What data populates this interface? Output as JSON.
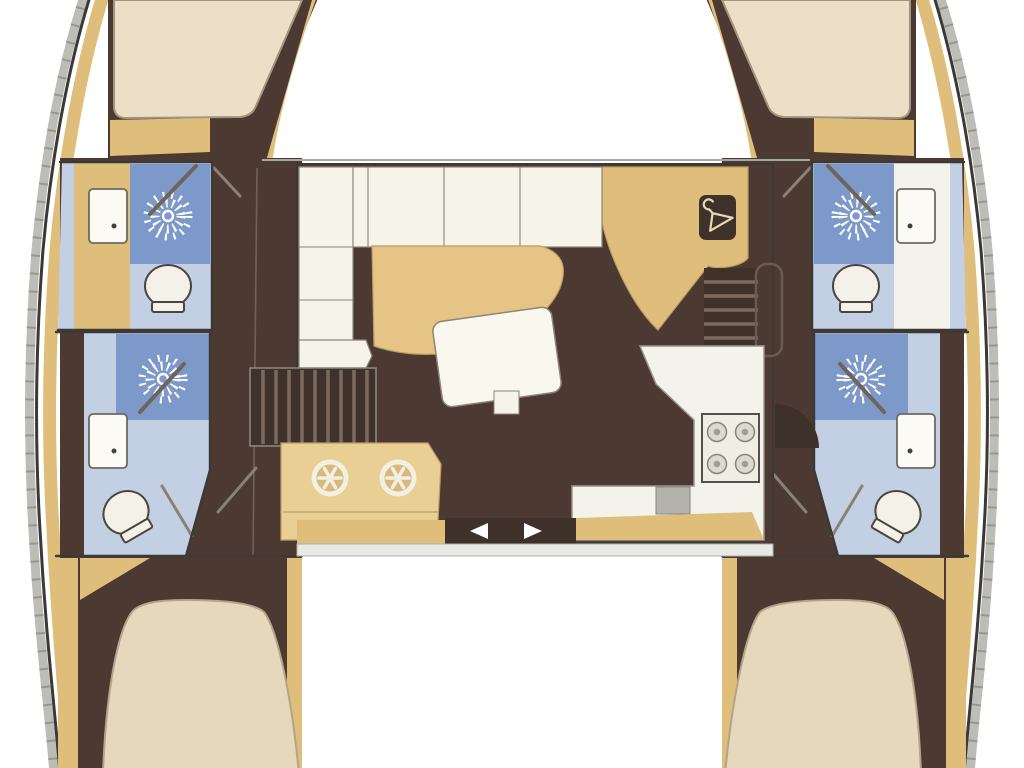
{
  "description": "Top-down floor plan of a 4-cabin / 4-head sailing catamaran: two symmetric hulls joined by a central salon with galley",
  "palette": {
    "background": "#ffffff",
    "hull_floor": "#4c3a32",
    "hull_floor_dark": "#3e3129",
    "wood": "#dfbe7b",
    "wood_light": "#e9cf94",
    "wood_table": "#e5c486",
    "mattress": "#ebdfc7",
    "mattress_aft": "#e6d8bd",
    "sofa": "#f6f3e9",
    "table_white": "#faf7ee",
    "counter_white": "#f3f3ec",
    "stove_body": "#efede4",
    "shower_blue": "#7d99ca",
    "bath_blue": "#c3cfe3",
    "fixture_white": "#f4f1e9",
    "sink_grey": "#b3b3ab",
    "track_grey": "#e9e9e4",
    "slot_dark": "#6b6257",
    "steps_dark": "#3f322b",
    "hanger_box": "#3f322b",
    "hanger_glyph": "#e8d9b8",
    "arrow_white": "#ffffff",
    "outline": "#3c3835",
    "rubrail_grey": "#bdbdb8"
  },
  "icons": {
    "shower": "sunburst-rays",
    "toilet": "oval-bowl-with-base",
    "sink": "rounded-rect-with-faucet-dot",
    "stove": "square-with-four-burners",
    "galley_twin_sinks": "twin-circles-with-star-spokes",
    "wardrobe": "clothes-hanger",
    "companionway": "striped-steps",
    "sliding_door": "left-right-arrows"
  },
  "legend": {
    "hulls": 2,
    "cabins": 4,
    "bathrooms": 4,
    "showers": 4,
    "toilets": 4,
    "salon": 1,
    "galley": 1
  }
}
